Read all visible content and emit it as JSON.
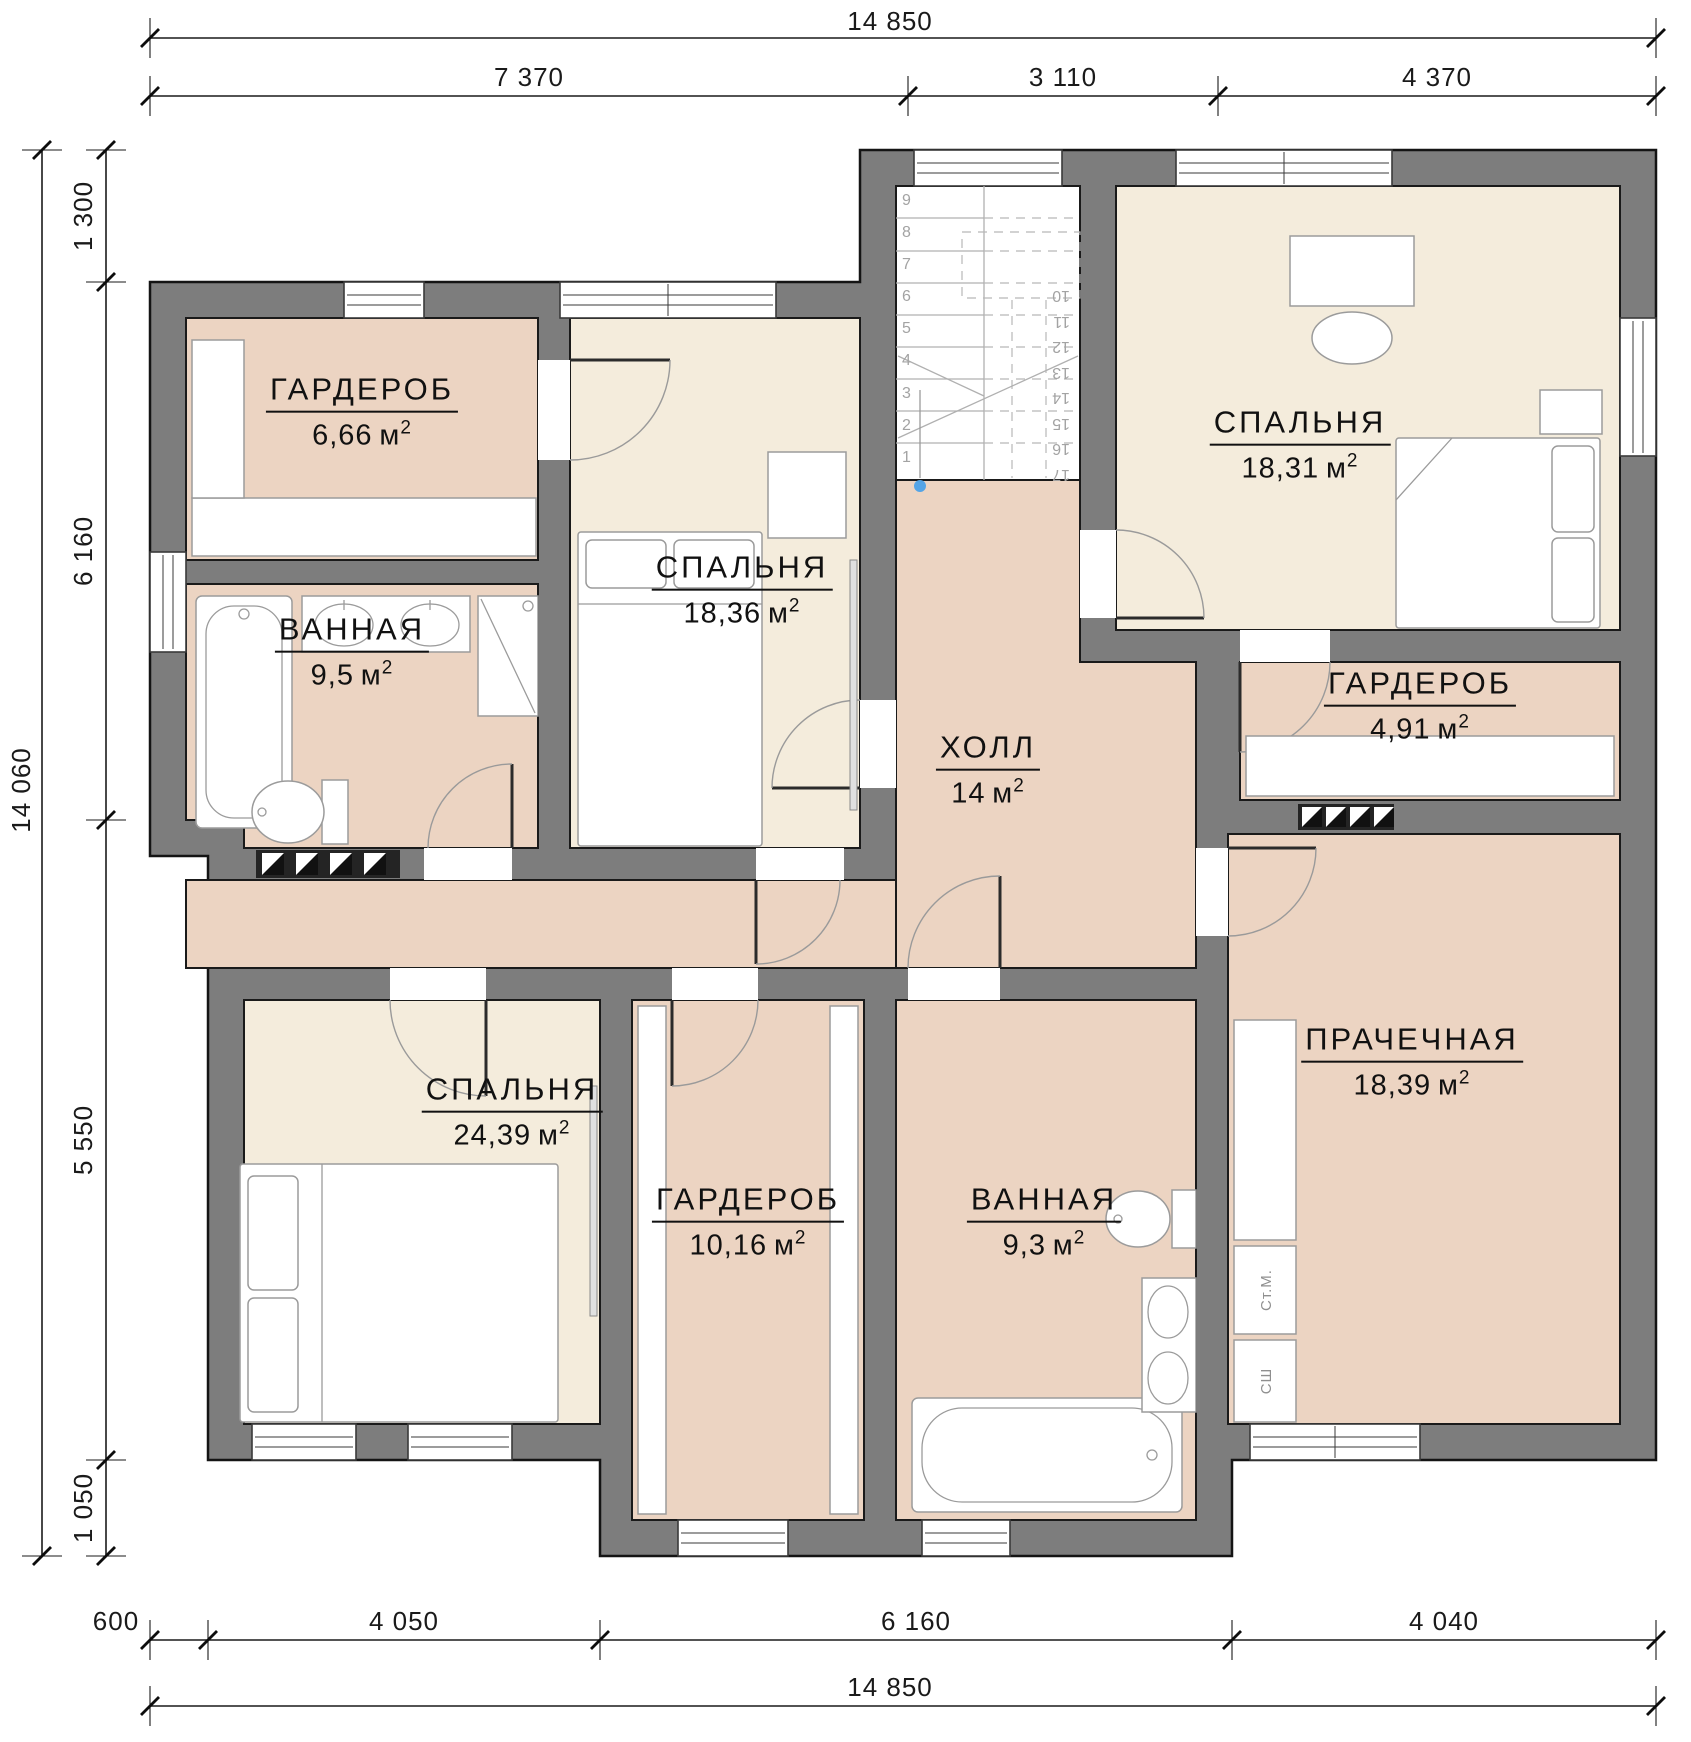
{
  "units": {
    "unit": "м",
    "sup": "2"
  },
  "rooms": [
    {
      "id": "garderob-666",
      "name": "ГАРДЕРОБ",
      "area": "6,66"
    },
    {
      "id": "bedroom-1836",
      "name": "СПАЛЬНЯ",
      "area": "18,36"
    },
    {
      "id": "bathroom-95",
      "name": "ВАННАЯ",
      "area": "9,5"
    },
    {
      "id": "bedroom-1831",
      "name": "СПАЛЬНЯ",
      "area": "18,31"
    },
    {
      "id": "hall-14",
      "name": "ХОЛЛ",
      "area": "14"
    },
    {
      "id": "garderob-491",
      "name": "ГАРДЕРОБ",
      "area": "4,91"
    },
    {
      "id": "bedroom-2439",
      "name": "СПАЛЬНЯ",
      "area": "24,39"
    },
    {
      "id": "garderob-1016",
      "name": "ГАРДЕРОБ",
      "area": "10,16"
    },
    {
      "id": "bathroom-93",
      "name": "ВАННАЯ",
      "area": "9,3"
    },
    {
      "id": "laundry-1839",
      "name": "ПРАЧЕЧНАЯ",
      "area": "18,39"
    }
  ],
  "dims": {
    "top_overall": "14 850",
    "top_segments": [
      "7 370",
      "3 110",
      "4 370"
    ],
    "left_overall": "14 060",
    "left_segments": [
      "1 300",
      "6 160",
      "5 550",
      "1 050"
    ],
    "bottom_segments": [
      "600",
      "4 050",
      "6 160",
      "4 040"
    ],
    "bottom_overall": "14 850"
  },
  "stairs": {
    "lower": [
      "1",
      "2",
      "3",
      "4",
      "5",
      "6",
      "7",
      "8",
      "9"
    ],
    "upper": [
      "10",
      "11",
      "12",
      "13",
      "14",
      "15",
      "16",
      "17"
    ]
  },
  "appliances": {
    "washer": "Ст.М.",
    "dryer": "СШ"
  },
  "colors": {
    "wall": "#7d7d7d",
    "room_pink": "#ecd4c2",
    "room_cream": "#f4ecdc",
    "line": "#141414",
    "entry_dot_blue": "#54a4e6"
  }
}
